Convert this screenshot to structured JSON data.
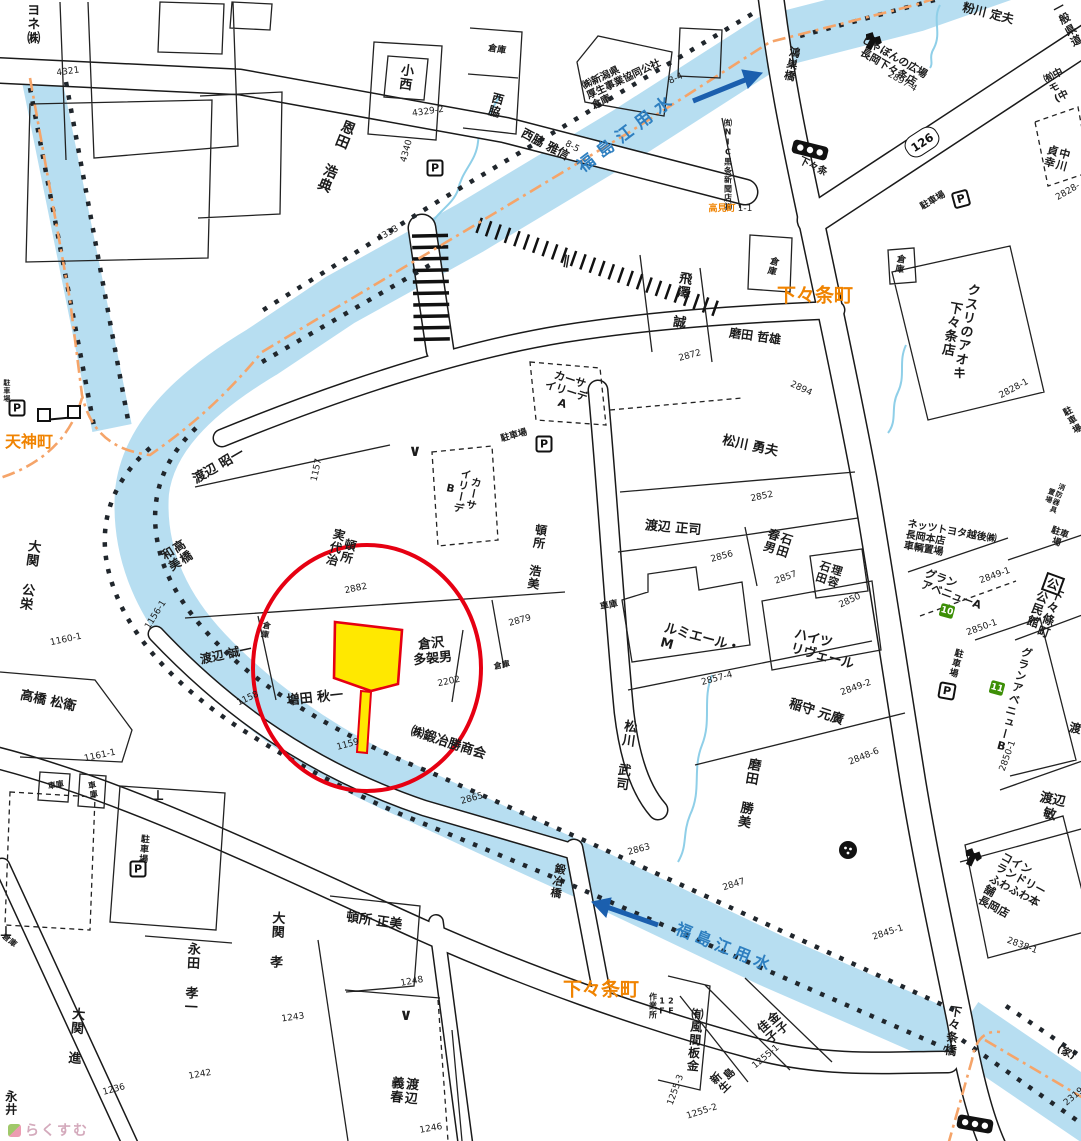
{
  "colors": {
    "water": "#b7def1",
    "river_text": "#2e7fc0",
    "arrow": "#1b5fae",
    "orange": "#f08300",
    "boundary": "#f5a469",
    "red": "#e60012",
    "yellow": "#ffe800",
    "green": "#3d8f07",
    "ink": "#1b1b1b",
    "watermark": "#d4aabc"
  },
  "watermark": {
    "text": "らくすむ"
  },
  "waterway": {
    "name": "福島江用水"
  },
  "labels": [
    {
      "n": "company-yone",
      "t": "ヨネ㈱",
      "x": 31,
      "y": 24,
      "r": 0,
      "s": 13,
      "v": 1
    },
    {
      "n": "parcel-number",
      "t": "4321",
      "x": 68,
      "y": 72,
      "r": -8,
      "s": 9,
      "w": 400
    },
    {
      "n": "resident-onda",
      "t": "恩田 浩典",
      "x": 335,
      "y": 156,
      "r": 22,
      "s": 14,
      "v": 1
    },
    {
      "n": "resident-konishi",
      "t": "小西",
      "x": 404,
      "y": 77,
      "r": 8,
      "s": 13,
      "v": 1
    },
    {
      "n": "parcel-number",
      "t": "4329-2",
      "x": 428,
      "y": 112,
      "r": -8,
      "s": 9,
      "w": 400
    },
    {
      "n": "warehouse-label",
      "t": "倉庫",
      "x": 497,
      "y": 50,
      "r": 10,
      "s": 9
    },
    {
      "n": "resident-nishiwaki",
      "t": "西脇",
      "x": 495,
      "y": 105,
      "r": 15,
      "s": 12,
      "v": 1
    },
    {
      "n": "parcel-number",
      "t": "4340",
      "x": 407,
      "y": 151,
      "r": -75,
      "s": 9,
      "w": 400
    },
    {
      "n": "resident-nishiwaki-masanobu",
      "t": "西脇 雅信",
      "x": 545,
      "y": 145,
      "r": 28,
      "s": 12
    },
    {
      "n": "parcel-number",
      "t": "8-5",
      "x": 572,
      "y": 147,
      "r": 28,
      "s": 9,
      "w": 400
    },
    {
      "n": "company-kosei",
      "t": "㈱新潟県\n厚生事業協同公社\n倉庫",
      "x": 624,
      "y": 80,
      "r": -25,
      "s": 10,
      "a": "left"
    },
    {
      "n": "parcel-number",
      "t": "8-4",
      "x": 676,
      "y": 79,
      "r": -25,
      "s": 9,
      "w": 400
    },
    {
      "n": "river-name-upper",
      "t": "福島江用水",
      "x": 628,
      "y": 133,
      "r": -37,
      "s": 17,
      "c": "river_text",
      "w": 700,
      "sp": 7
    },
    {
      "n": "bridge-kounosu",
      "t": "鴻巣橋",
      "x": 791,
      "y": 64,
      "r": 12,
      "s": 11,
      "v": 1
    },
    {
      "n": "shop-shabon",
      "t": "しゃぼんの広場\n長岡下々条店",
      "x": 891,
      "y": 63,
      "r": 30,
      "s": 10.5
    },
    {
      "n": "parcel-number",
      "t": "2897-4",
      "x": 902,
      "y": 82,
      "r": 30,
      "s": 9,
      "w": 400
    },
    {
      "n": "resident-kokawa",
      "t": "粉川 定夫",
      "x": 988,
      "y": 14,
      "r": 14,
      "s": 12
    },
    {
      "n": "road-class-label",
      "t": "一般県道",
      "x": 1068,
      "y": 25,
      "r": -28,
      "s": 11
    },
    {
      "n": "company-naka-partial",
      "t": "㈲中\nモ\n(中",
      "x": 1059,
      "y": 86,
      "r": -28,
      "s": 10,
      "a": "left"
    },
    {
      "n": "resident-nakagawa",
      "t": "中川\n貞幸",
      "x": 1056,
      "y": 158,
      "r": 15,
      "s": 11,
      "v": 1
    },
    {
      "n": "parcel-number",
      "t": "2828-",
      "x": 1068,
      "y": 192,
      "r": -30,
      "s": 9,
      "w": 400
    },
    {
      "n": "parking-label",
      "t": "駐車場",
      "x": 933,
      "y": 201,
      "r": -30,
      "s": 9
    },
    {
      "n": "company-nic",
      "t": "㈲NIC黒条新聞店㈱",
      "x": 727,
      "y": 165,
      "r": 0,
      "s": 8,
      "v": 1
    },
    {
      "n": "town-takamicho",
      "t": "高見町",
      "x": 722,
      "y": 209,
      "r": 0,
      "s": 9,
      "c": "orange"
    },
    {
      "n": "parcel-number",
      "t": "1-1",
      "x": 745,
      "y": 209,
      "r": 0,
      "s": 9,
      "w": 400
    },
    {
      "n": "signal-label-shimojojo",
      "t": "下々条",
      "x": 813,
      "y": 167,
      "r": 26,
      "s": 10
    },
    {
      "n": "warehouse-label",
      "t": "倉庫",
      "x": 772,
      "y": 266,
      "r": 15,
      "s": 9,
      "v": 1
    },
    {
      "n": "town-shimojojo-upper",
      "t": "下々条町",
      "x": 815,
      "y": 296,
      "r": 0,
      "s": 19,
      "c": "orange",
      "w": 700
    },
    {
      "n": "resident-tobisawa",
      "t": "飛澤 誠",
      "x": 680,
      "y": 300,
      "r": 8,
      "s": 13,
      "v": 1
    },
    {
      "n": "parcel-number",
      "t": "2872",
      "x": 690,
      "y": 356,
      "r": -15,
      "s": 9,
      "w": 400
    },
    {
      "n": "resident-maita-tetsuo",
      "t": "磨田 哲雄",
      "x": 755,
      "y": 337,
      "r": 8,
      "s": 12
    },
    {
      "n": "parcel-number",
      "t": "2894",
      "x": 801,
      "y": 389,
      "r": 25,
      "s": 9,
      "w": 400
    },
    {
      "n": "warehouse-label",
      "t": "倉庫",
      "x": 899,
      "y": 264,
      "r": 10,
      "s": 9,
      "v": 1
    },
    {
      "n": "shop-kusuri-aoki",
      "t": "クスリのアオキ\n下々条店",
      "x": 957,
      "y": 330,
      "r": 10,
      "s": 13,
      "v": 1
    },
    {
      "n": "parcel-number",
      "t": "2828-1",
      "x": 1014,
      "y": 389,
      "r": -28,
      "s": 9,
      "w": 400
    },
    {
      "n": "parking-label",
      "t": "駐車場",
      "x": 1073,
      "y": 421,
      "r": -28,
      "s": 9
    },
    {
      "n": "building-casa-a",
      "t": "カーサ\nイリーデ\nA",
      "x": 566,
      "y": 392,
      "r": 18,
      "s": 11
    },
    {
      "n": "parking-label",
      "t": "駐車場",
      "x": 514,
      "y": 436,
      "r": -15,
      "s": 9
    },
    {
      "n": "gate-mark",
      "t": "∨",
      "x": 415,
      "y": 451,
      "r": 0,
      "s": 16,
      "w": 700
    },
    {
      "n": "building-casa-b",
      "t": "カーサ\nイリーデ\nB",
      "x": 461,
      "y": 491,
      "r": 12,
      "s": 10.5,
      "v": 1
    },
    {
      "n": "resident-tonsho-miyoji",
      "t": "頓所\n実代治",
      "x": 341,
      "y": 549,
      "r": 15,
      "s": 12,
      "v": 1
    },
    {
      "n": "parcel-number",
      "t": "2882",
      "x": 356,
      "y": 589,
      "r": -12,
      "s": 9,
      "w": 400
    },
    {
      "n": "parcel-number",
      "t": "1157",
      "x": 317,
      "y": 470,
      "r": -78,
      "s": 9,
      "w": 400
    },
    {
      "n": "resident-tonsho-hiromi",
      "t": "頓所 浩美",
      "x": 536,
      "y": 557,
      "r": 8,
      "s": 12,
      "v": 1
    },
    {
      "n": "parcel-number",
      "t": "2879",
      "x": 520,
      "y": 621,
      "r": -15,
      "s": 9,
      "w": 400
    },
    {
      "n": "resident-matsukawa-isao",
      "t": "松川 勇夫",
      "x": 750,
      "y": 447,
      "r": 12,
      "s": 13
    },
    {
      "n": "parcel-number",
      "t": "2852",
      "x": 762,
      "y": 497,
      "r": -12,
      "s": 9,
      "w": 400
    },
    {
      "n": "resident-watanabe-seiji",
      "t": "渡辺 正司",
      "x": 673,
      "y": 529,
      "r": 5,
      "s": 13
    },
    {
      "n": "parcel-number",
      "t": "2856",
      "x": 722,
      "y": 557,
      "r": -15,
      "s": 9,
      "w": 400
    },
    {
      "n": "resident-ishida-haruo",
      "t": "石田\n春男",
      "x": 777,
      "y": 543,
      "r": 18,
      "s": 12,
      "v": 1
    },
    {
      "n": "parcel-number",
      "t": "2857",
      "x": 786,
      "y": 578,
      "r": -20,
      "s": 9,
      "w": 400
    },
    {
      "n": "shop-riyo-ishida",
      "t": "理容\n石田",
      "x": 828,
      "y": 574,
      "r": 18,
      "s": 11,
      "v": 1
    },
    {
      "n": "parcel-number",
      "t": "2850",
      "x": 850,
      "y": 601,
      "r": -25,
      "s": 9,
      "w": 400
    },
    {
      "n": "garage-label",
      "t": "車庫",
      "x": 609,
      "y": 606,
      "r": -12,
      "s": 9
    },
    {
      "n": "building-lumiere",
      "t": "ルミエール・\nM",
      "x": 700,
      "y": 646,
      "r": 15,
      "s": 13,
      "a": "left"
    },
    {
      "n": "building-heights-rivere",
      "t": "ハイツ\nリヴェール",
      "x": 824,
      "y": 650,
      "r": 15,
      "s": 13,
      "a": "left"
    },
    {
      "n": "parcel-number",
      "t": "2857-4",
      "x": 717,
      "y": 679,
      "r": -15,
      "s": 9,
      "w": 400
    },
    {
      "n": "parcel-number",
      "t": "2849-2",
      "x": 856,
      "y": 688,
      "r": -20,
      "s": 9,
      "w": 400
    },
    {
      "n": "resident-inamori",
      "t": "稲守 元廣",
      "x": 816,
      "y": 713,
      "r": 18,
      "s": 13
    },
    {
      "n": "parcel-number",
      "t": "2848-6",
      "x": 864,
      "y": 757,
      "r": -22,
      "s": 9,
      "w": 400
    },
    {
      "n": "resident-matsukawa-takeshi",
      "t": "松川 武司",
      "x": 624,
      "y": 755,
      "r": 8,
      "s": 13,
      "v": 1
    },
    {
      "n": "resident-maita-katsumi",
      "t": "磨田 勝美",
      "x": 747,
      "y": 793,
      "r": 10,
      "s": 13,
      "v": 1
    },
    {
      "n": "parcel-number",
      "t": "2863",
      "x": 639,
      "y": 850,
      "r": -15,
      "s": 9,
      "w": 400
    },
    {
      "n": "parcel-number",
      "t": "2847",
      "x": 734,
      "y": 885,
      "r": -18,
      "s": 9,
      "w": 400
    },
    {
      "n": "bridge-kaji",
      "t": "鍛冶橋",
      "x": 557,
      "y": 881,
      "r": 10,
      "s": 11,
      "v": 1
    },
    {
      "n": "river-name-lower",
      "t": "福島江用水",
      "x": 725,
      "y": 948,
      "r": 22,
      "s": 16,
      "c": "river_text",
      "w": 700,
      "sp": 5
    },
    {
      "n": "town-shimojojo-lower",
      "t": "下々条町",
      "x": 601,
      "y": 990,
      "r": 0,
      "s": 19,
      "c": "orange",
      "w": 700
    },
    {
      "n": "building-floor-note",
      "t": "2F\n1F\n作業所",
      "x": 661,
      "y": 1006,
      "r": 0,
      "s": 8,
      "v": 1
    },
    {
      "n": "company-kazama",
      "t": "㈲風間板金",
      "x": 694,
      "y": 1040,
      "r": 5,
      "s": 12,
      "v": 1
    },
    {
      "n": "parcel-number",
      "t": "1255-3",
      "x": 676,
      "y": 1090,
      "r": -70,
      "s": 9,
      "w": 400
    },
    {
      "n": "parcel-number",
      "t": "1255-2",
      "x": 702,
      "y": 1112,
      "r": -18,
      "s": 9,
      "w": 400
    },
    {
      "n": "resident-niijima",
      "t": "島\n新生",
      "x": 724,
      "y": 1079,
      "r": -45,
      "s": 11,
      "v": 1
    },
    {
      "n": "resident-kaneko",
      "t": "金子\n佳子",
      "x": 772,
      "y": 1028,
      "r": -40,
      "s": 12,
      "v": 1
    },
    {
      "n": "parcel-number",
      "t": "1255-1",
      "x": 766,
      "y": 1057,
      "r": -40,
      "s": 9,
      "w": 400
    },
    {
      "n": "resident-tonsho-masami",
      "t": "頓所 正美",
      "x": 374,
      "y": 922,
      "r": 8,
      "s": 13
    },
    {
      "n": "parcel-number",
      "t": "1248",
      "x": 412,
      "y": 982,
      "r": -10,
      "s": 9,
      "w": 400
    },
    {
      "n": "gate-mark",
      "t": "∨",
      "x": 406,
      "y": 1015,
      "r": 0,
      "s": 16,
      "w": 700
    },
    {
      "n": "resident-watanabe-yoshiharu",
      "t": "渡辺 義春",
      "x": 402,
      "y": 1090,
      "r": 5,
      "s": 13,
      "v": 1
    },
    {
      "n": "parcel-number",
      "t": "1246",
      "x": 431,
      "y": 1129,
      "r": -10,
      "s": 9,
      "w": 400
    },
    {
      "n": "resident-ozeki-takashi",
      "t": "大関 孝",
      "x": 275,
      "y": 940,
      "r": 3,
      "s": 13,
      "v": 1
    },
    {
      "n": "parcel-number",
      "t": "1243",
      "x": 293,
      "y": 1018,
      "r": -8,
      "s": 9,
      "w": 400
    },
    {
      "n": "resident-nagata",
      "t": "永田 孝一",
      "x": 190,
      "y": 978,
      "r": 3,
      "s": 13,
      "v": 1
    },
    {
      "n": "parcel-number",
      "t": "1242",
      "x": 200,
      "y": 1075,
      "r": -10,
      "s": 9,
      "w": 400
    },
    {
      "n": "resident-ozeki-susumu",
      "t": "大関 進",
      "x": 74,
      "y": 1036,
      "r": 5,
      "s": 13,
      "v": 1
    },
    {
      "n": "parcel-number",
      "t": "1236",
      "x": 114,
      "y": 1090,
      "r": -15,
      "s": 9,
      "w": 400
    },
    {
      "n": "resident-nagai",
      "t": "永井",
      "x": 10,
      "y": 1103,
      "r": 0,
      "s": 12,
      "v": 1
    },
    {
      "n": "resident-takahashi-matsue",
      "t": "高橋 松衛",
      "x": 48,
      "y": 702,
      "r": 12,
      "s": 13
    },
    {
      "n": "parcel-number",
      "t": "1161-1",
      "x": 100,
      "y": 756,
      "r": -12,
      "s": 9,
      "w": 400
    },
    {
      "n": "garage-label",
      "t": "車庫",
      "x": 56,
      "y": 786,
      "r": -10,
      "s": 8
    },
    {
      "n": "garage-label",
      "t": "車庫",
      "x": 92,
      "y": 790,
      "r": -10,
      "s": 8,
      "v": 1
    },
    {
      "n": "parking-label",
      "t": "駐車場",
      "x": 143,
      "y": 849,
      "r": 5,
      "s": 9,
      "v": 1
    },
    {
      "n": "warehouse-label",
      "t": "倉庫",
      "x": 9,
      "y": 941,
      "r": 40,
      "s": 8
    },
    {
      "n": "resident-watanabe-seiichi",
      "t": "渡辺 誠一",
      "x": 226,
      "y": 655,
      "r": -12,
      "s": 12
    },
    {
      "n": "warehouse-label",
      "t": "倉庫",
      "x": 265,
      "y": 630,
      "r": 10,
      "s": 8,
      "v": 1
    },
    {
      "n": "parcel-number",
      "t": "1158",
      "x": 248,
      "y": 699,
      "r": -25,
      "s": 9,
      "w": 400
    },
    {
      "n": "resident-masuda",
      "t": "増田 秋一",
      "x": 315,
      "y": 699,
      "r": -6,
      "s": 13
    },
    {
      "n": "parcel-number",
      "t": "1159",
      "x": 348,
      "y": 745,
      "r": -15,
      "s": 9,
      "w": 400
    },
    {
      "n": "resident-kurasawa",
      "t": "倉沢\n多袈男",
      "x": 432,
      "y": 652,
      "r": -6,
      "s": 13
    },
    {
      "n": "parcel-number",
      "t": "2202",
      "x": 449,
      "y": 682,
      "r": -12,
      "s": 9,
      "w": 400
    },
    {
      "n": "warehouse-label",
      "t": "倉庫",
      "x": 502,
      "y": 666,
      "r": -12,
      "s": 8
    },
    {
      "n": "company-kajikatsu",
      "t": "㈱鍛冶勝商会",
      "x": 448,
      "y": 744,
      "r": 18,
      "s": 13
    },
    {
      "n": "parcel-number",
      "t": "2865",
      "x": 472,
      "y": 799,
      "r": -15,
      "s": 9,
      "w": 400
    },
    {
      "n": "resident-watanabe-akiichi",
      "t": "渡辺 昭一",
      "x": 219,
      "y": 467,
      "r": -30,
      "s": 13
    },
    {
      "n": "resident-takahashi-kazumi",
      "t": "高橋\n和美",
      "x": 176,
      "y": 556,
      "r": -32,
      "s": 12,
      "v": 1
    },
    {
      "n": "resident-ozeki-koei",
      "t": "大関 公栄",
      "x": 28,
      "y": 575,
      "r": 8,
      "s": 13,
      "v": 1
    },
    {
      "n": "parcel-number",
      "t": "1160-1",
      "x": 66,
      "y": 640,
      "r": -12,
      "s": 9,
      "w": 400
    },
    {
      "n": "parcel-number",
      "t": "1156-1",
      "x": 156,
      "y": 615,
      "r": -58,
      "s": 9,
      "w": 400
    },
    {
      "n": "town-tenjincho",
      "t": "天神町",
      "x": 29,
      "y": 442,
      "r": 0,
      "s": 16,
      "c": "orange",
      "w": 700
    },
    {
      "n": "parking-label",
      "t": "駐車場",
      "x": 6,
      "y": 391,
      "r": 0,
      "s": 7,
      "v": 1
    },
    {
      "n": "company-netz-toyota",
      "t": "ネッツトヨタ越後㈱\n長岡本店\n車輌置場",
      "x": 950,
      "y": 543,
      "r": 10,
      "s": 10,
      "a": "left"
    },
    {
      "n": "parcel-number",
      "t": "2849-1",
      "x": 995,
      "y": 576,
      "r": -20,
      "s": 9,
      "w": 400
    },
    {
      "n": "building-glan-avenue-a",
      "t": "グラン\nアベニューA",
      "x": 953,
      "y": 590,
      "r": 20,
      "s": 11,
      "a": "left"
    },
    {
      "n": "parcel-number",
      "t": "2850-1",
      "x": 982,
      "y": 628,
      "r": -20,
      "s": 9,
      "w": 400
    },
    {
      "n": "parking-label",
      "t": "駐車場",
      "x": 955,
      "y": 663,
      "r": 15,
      "s": 9,
      "v": 1
    },
    {
      "n": "building-glan-avenue-b",
      "t": "グランアベニューB",
      "x": 1013,
      "y": 700,
      "r": 15,
      "s": 11,
      "v": 1
    },
    {
      "n": "parcel-number",
      "t": "2850-1",
      "x": 1008,
      "y": 756,
      "r": -70,
      "s": 9,
      "w": 400
    },
    {
      "n": "facility-kouminkan",
      "t": "下々條町\n公民館",
      "x": 1043,
      "y": 611,
      "r": 20,
      "s": 12,
      "v": 1
    },
    {
      "n": "facility-fire-equipment",
      "t": "消防器具\n置場",
      "x": 1053,
      "y": 497,
      "r": 20,
      "s": 7,
      "v": 1
    },
    {
      "n": "parking-label",
      "t": "駐車場",
      "x": 1058,
      "y": 538,
      "r": 20,
      "s": 9
    },
    {
      "n": "resident-watanabe-toshi",
      "t": "渡辺 敏",
      "x": 1051,
      "y": 808,
      "r": 12,
      "s": 13
    },
    {
      "n": "resident-watanabe-partial",
      "t": "渡",
      "x": 1075,
      "y": 729,
      "r": 12,
      "s": 12
    },
    {
      "n": "parcel-number",
      "t": "2845-1",
      "x": 888,
      "y": 933,
      "r": -18,
      "s": 9,
      "w": 400
    },
    {
      "n": "shop-coin-laundry",
      "t": "コイン\nランドリー\nふわふわ本舗\n長岡店",
      "x": 1018,
      "y": 893,
      "r": 28,
      "s": 11,
      "a": "left"
    },
    {
      "n": "parcel-number",
      "t": "2838-1",
      "x": 1022,
      "y": 946,
      "r": 20,
      "s": 9,
      "w": 400
    },
    {
      "n": "bridge-shimojojo",
      "t": "下々条橋",
      "x": 952,
      "y": 1031,
      "r": 8,
      "s": 12,
      "v": 1
    },
    {
      "n": "house-note",
      "t": "(家)",
      "x": 1066,
      "y": 1053,
      "r": 25,
      "s": 10
    },
    {
      "n": "parcel-number",
      "t": "2319",
      "x": 1074,
      "y": 1097,
      "r": -40,
      "s": 9,
      "w": 400
    },
    {
      "n": "parcel-number",
      "t": "4333",
      "x": 388,
      "y": 234,
      "r": -30,
      "s": 9,
      "w": 400
    },
    {
      "n": "bridge-mark",
      "t": "∥",
      "x": 566,
      "y": 262,
      "r": 10,
      "s": 13,
      "w": 700
    },
    {
      "n": "pole-mark",
      "t": "⊥",
      "x": 158,
      "y": 797,
      "r": 0,
      "s": 14,
      "w": 700
    },
    {
      "n": "pole-mark",
      "t": "⊥",
      "x": 6,
      "y": 933,
      "r": 0,
      "s": 14,
      "w": 700
    }
  ],
  "badges": [
    {
      "n": "parking-badge",
      "t": "P",
      "type": "p",
      "x": 435,
      "y": 168,
      "r": 0
    },
    {
      "n": "parking-badge",
      "t": "P",
      "type": "p",
      "x": 961,
      "y": 199,
      "r": -15
    },
    {
      "n": "parking-badge",
      "t": "P",
      "type": "p",
      "x": 544,
      "y": 444,
      "r": 0
    },
    {
      "n": "parking-badge",
      "t": "P",
      "type": "p",
      "x": 17,
      "y": 408,
      "r": 0
    },
    {
      "n": "parking-badge",
      "t": "P",
      "type": "p",
      "x": 138,
      "y": 869,
      "r": 0
    },
    {
      "n": "parking-badge",
      "t": "P",
      "type": "p",
      "x": 947,
      "y": 691,
      "r": 10
    },
    {
      "n": "route-badge-126",
      "t": "126",
      "type": "route",
      "x": 922,
      "y": 142,
      "r": -33
    },
    {
      "n": "block-badge-10",
      "t": "10",
      "type": "green",
      "x": 947,
      "y": 611,
      "r": 15
    },
    {
      "n": "block-badge-11",
      "t": "11",
      "type": "green",
      "x": 997,
      "y": 688,
      "r": 15
    },
    {
      "n": "kouminkan-badge",
      "t": "公",
      "type": "kou",
      "x": 1053,
      "y": 584,
      "r": 20
    }
  ]
}
